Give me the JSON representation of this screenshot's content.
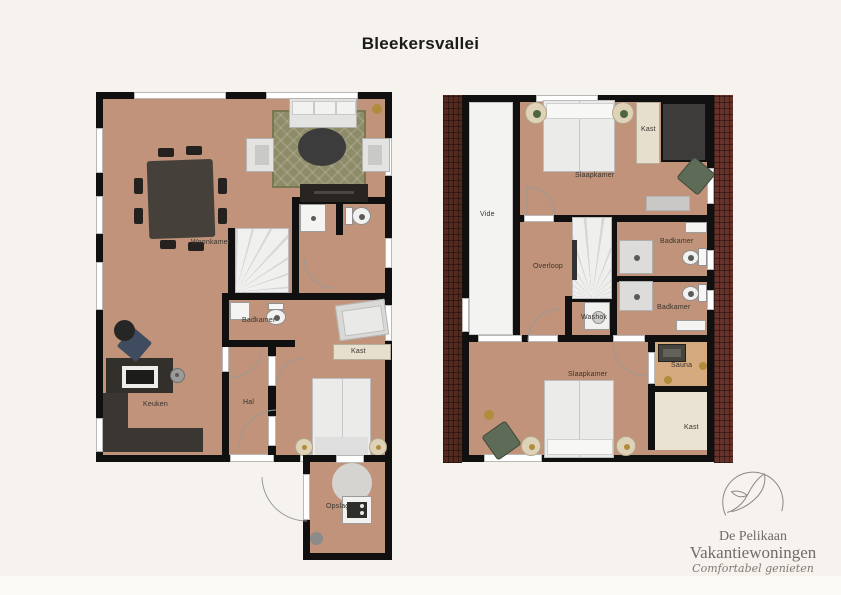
{
  "title": "Bleekersvallei",
  "ground_floor": {
    "labels": {
      "woonkamer": "Woonkamer",
      "badkamer": "Badkamer",
      "kast": "Kast",
      "hal": "Hal",
      "keuken": "Keuken",
      "opslag": "Opslag"
    }
  },
  "upper_floor": {
    "labels": {
      "vide": "Vide",
      "slaapkamer_top": "Slaapkamer",
      "kast_top": "Kast",
      "overloop": "Overloop",
      "badkamer_top": "Badkamer",
      "badkamer_bottom": "Badkamer",
      "washok": "Washok",
      "slaapkamer_bottom": "Slaapkamer",
      "sauna": "Sauna",
      "kast_bottom": "Kast"
    }
  },
  "logo": {
    "brand_line1": "De Pelikaan",
    "brand_line2": "Vakantiewoningen",
    "tagline": "Comfortabel genieten"
  },
  "colors": {
    "background": "#f6f3ee",
    "floor_tan": "#c0937a",
    "wall_black": "#101010",
    "rug_olive": "#8e8c68",
    "brick_left": "#54291e",
    "brick_right": "#67322a",
    "sauna_floor": "#d4aa7e",
    "kast_floor": "#eae3d3",
    "logo_gray": "#6f6b66",
    "accent_gold": "#b08c3c"
  }
}
